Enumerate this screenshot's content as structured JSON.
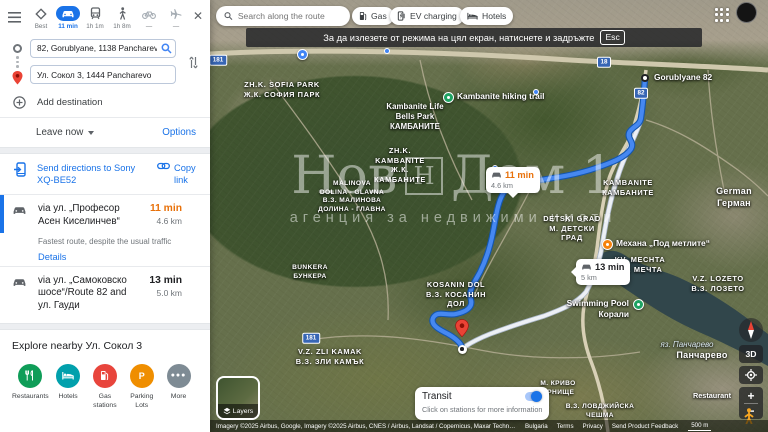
{
  "sidebar": {
    "modes": {
      "best": "Best",
      "drive": "11 min",
      "transit": "1h 1m",
      "walk": "1h 8m",
      "bike": "—",
      "flight": "—"
    },
    "origin_value": "82, Gorublyane, 1138 Pancharevo",
    "destination_value": "Ул. Сокол 3, 1444 Pancharevo",
    "add_destination": "Add destination",
    "leave_now": "Leave now",
    "options": "Options",
    "send_directions": "Send directions to Sony XQ-BE52",
    "copy_link": "Copy link",
    "routes": [
      {
        "via": "via ул. „Професор Асен Киселинчев“",
        "time": "11 min",
        "time_color": "#e8710a",
        "distance": "4.6 km",
        "note": "Fastest route, despite the usual traffic",
        "details": "Details"
      },
      {
        "via": "via ул. „Самоковско шосе“/Route 82 and ул. Гауди",
        "time": "13 min",
        "time_color": "#202124",
        "distance": "5.0 km"
      }
    ],
    "explore": {
      "title": "Explore nearby Ул. Сокол 3",
      "categories": [
        {
          "label": "Restaurants",
          "color": "#0f9d58",
          "icon": "fork-knife"
        },
        {
          "label": "Hotels",
          "color": "#01a0ac",
          "icon": "bed"
        },
        {
          "label": "Gas stations",
          "color": "#e8453c",
          "icon": "gas-pump"
        },
        {
          "label": "Parking Lots",
          "color": "#ef8e00",
          "icon": "P"
        },
        {
          "label": "More",
          "color": "#7e8b94",
          "icon": "•••"
        }
      ]
    }
  },
  "map": {
    "search_placeholder": "Search along the route",
    "chips": [
      "Gas",
      "EV charging",
      "Hotels"
    ],
    "toast": {
      "text": "За да излезете от режима на цял екран, натиснете и задръжте",
      "key": "Esc"
    },
    "watermark": {
      "title_left": "Нов",
      "logo": "Н",
      "title_right": "Дом 1",
      "subtitle": "агенция за недвижими имоти"
    },
    "badges": [
      {
        "time": "11 min",
        "time_color": "#e8710a",
        "distance": "4.6 km"
      },
      {
        "time": "13 min",
        "time_color": "#202124",
        "distance": "5 km"
      }
    ],
    "route_colors": {
      "primary": "#4688f1",
      "primary_casing": "#1456ad",
      "alternate": "#edf0f5"
    },
    "labels": [
      {
        "x": 72,
        "y": 80,
        "cls": "area",
        "lines": [
          "ZH.K. SOFIA PARK",
          "Ж.К. СОФИЯ ПАРК"
        ]
      },
      {
        "x": 205,
        "y": 102,
        "cls": "poiTxt",
        "lines": [
          "Kambanite Life",
          "Bells Park",
          "КАМБАНИТЕ"
        ]
      },
      {
        "x": 190,
        "y": 146,
        "cls": "area",
        "lines": [
          "ZH.K.",
          "KAMBANITE",
          "Ж.К.",
          "КАМБАНИТЕ"
        ]
      },
      {
        "x": 418,
        "y": 178,
        "cls": "area",
        "lines": [
          "KAMBANITE",
          "КАМБАНИТЕ"
        ]
      },
      {
        "x": 362,
        "y": 214,
        "cls": "area",
        "lines": [
          "DETSKI GRAD",
          "М. ДЕТСКИ",
          "ГРАД"
        ]
      },
      {
        "x": 142,
        "y": 180,
        "cls": "areaSm",
        "lines": [
          "MALINOVA",
          "DOLINA - GLAVNA",
          "В.З. МАЛИНОВА",
          "ДОЛИНА - ГЛАВНА"
        ]
      },
      {
        "x": 100,
        "y": 264,
        "cls": "areaSm",
        "lines": [
          "BUNKERA",
          "БУНКЕРА"
        ]
      },
      {
        "x": 246,
        "y": 280,
        "cls": "area",
        "lines": [
          "KOSANIN DOL",
          "В.З. КОСАНИН",
          "ДОЛ"
        ]
      },
      {
        "x": 120,
        "y": 347,
        "cls": "area",
        "lines": [
          "V.Z. ZLI KAMAK",
          "В.З. ЗЛИ КАМЪК"
        ]
      },
      {
        "x": 430,
        "y": 255,
        "cls": "area",
        "lines": [
          "KV. MECHTA",
          "КВ. МЕЧТА"
        ]
      },
      {
        "x": 508,
        "y": 274,
        "cls": "area",
        "lines": [
          "V.Z. LOZETO",
          "В.З. ЛОЗЕТО"
        ]
      },
      {
        "x": 524,
        "y": 186,
        "cls": "town",
        "lines": [
          "German",
          "Герман"
        ]
      },
      {
        "x": 477,
        "y": 340,
        "cls": "water",
        "lines": [
          "яз. Панчарево"
        ]
      },
      {
        "x": 492,
        "y": 350,
        "cls": "town",
        "lines": [
          "Панчарево"
        ]
      },
      {
        "x": 348,
        "y": 380,
        "cls": "areaSm",
        "lines": [
          "М. КРИВО",
          "ОРНИЩЕ"
        ]
      },
      {
        "x": 390,
        "y": 403,
        "cls": "areaSm",
        "lines": [
          "В.З. ЛОВДЖИЙСКА",
          "ЧЕШМА"
        ]
      },
      {
        "x": 502,
        "y": 391,
        "cls": "townSm",
        "lines": [
          "Restaurant"
        ]
      }
    ],
    "markers": [
      {
        "type": "start",
        "x": 435,
        "y": 78,
        "label": "Gorublyane 82",
        "side": "right",
        "name": "route-start-marker"
      },
      {
        "type": "pin",
        "x": 252,
        "y": 337,
        "name": "destination-pin"
      },
      {
        "type": "target",
        "x": 252,
        "y": 349,
        "name": "destination-point"
      },
      {
        "type": "poi",
        "color": "#1ea362",
        "x": 238,
        "y": 97,
        "label": "Kambanite hiking trail",
        "side": "right",
        "name": "poi-hiking-trail"
      },
      {
        "type": "poi",
        "color": "#1ea362",
        "x": 428,
        "y": 304,
        "label": "Swimming Pool\nКорали",
        "side": "left",
        "name": "poi-swimming-pool"
      },
      {
        "type": "poi",
        "color": "#f5820d",
        "x": 397,
        "y": 244,
        "label": "Механа „Под метлите“",
        "side": "right",
        "name": "poi-restaurant"
      },
      {
        "type": "poi",
        "color": "#4285f4",
        "x": 92,
        "y": 54,
        "name": "poi-blue"
      },
      {
        "type": "dot",
        "x": 177,
        "y": 51,
        "name": "transit-stop"
      },
      {
        "type": "dot",
        "x": 326,
        "y": 92,
        "name": "transit-stop"
      },
      {
        "type": "dot",
        "x": 285,
        "y": 168,
        "name": "transit-stop"
      }
    ],
    "shields": [
      {
        "t": "181",
        "x": 8,
        "y": 60
      },
      {
        "t": "18",
        "x": 394,
        "y": 62
      },
      {
        "t": "82",
        "x": 431,
        "y": 93
      },
      {
        "t": "181",
        "x": 101,
        "y": 338
      }
    ],
    "transit": {
      "title": "Transit",
      "subtitle": "Click on stations for more information"
    },
    "layers_label": "Layers",
    "controls": {
      "three_d": "3D",
      "zoom_in": "+",
      "zoom_out": "−"
    },
    "attribution": {
      "imagery": "Imagery ©2025 Airbus, Google, Imagery ©2025 Airbus, CNES / Airbus, Landsat / Copernicus, Maxar Technologies, Map data ©2025",
      "links": [
        "Bulgaria",
        "Terms",
        "Privacy",
        "Send Product Feedback"
      ],
      "scale": "500 m"
    }
  }
}
